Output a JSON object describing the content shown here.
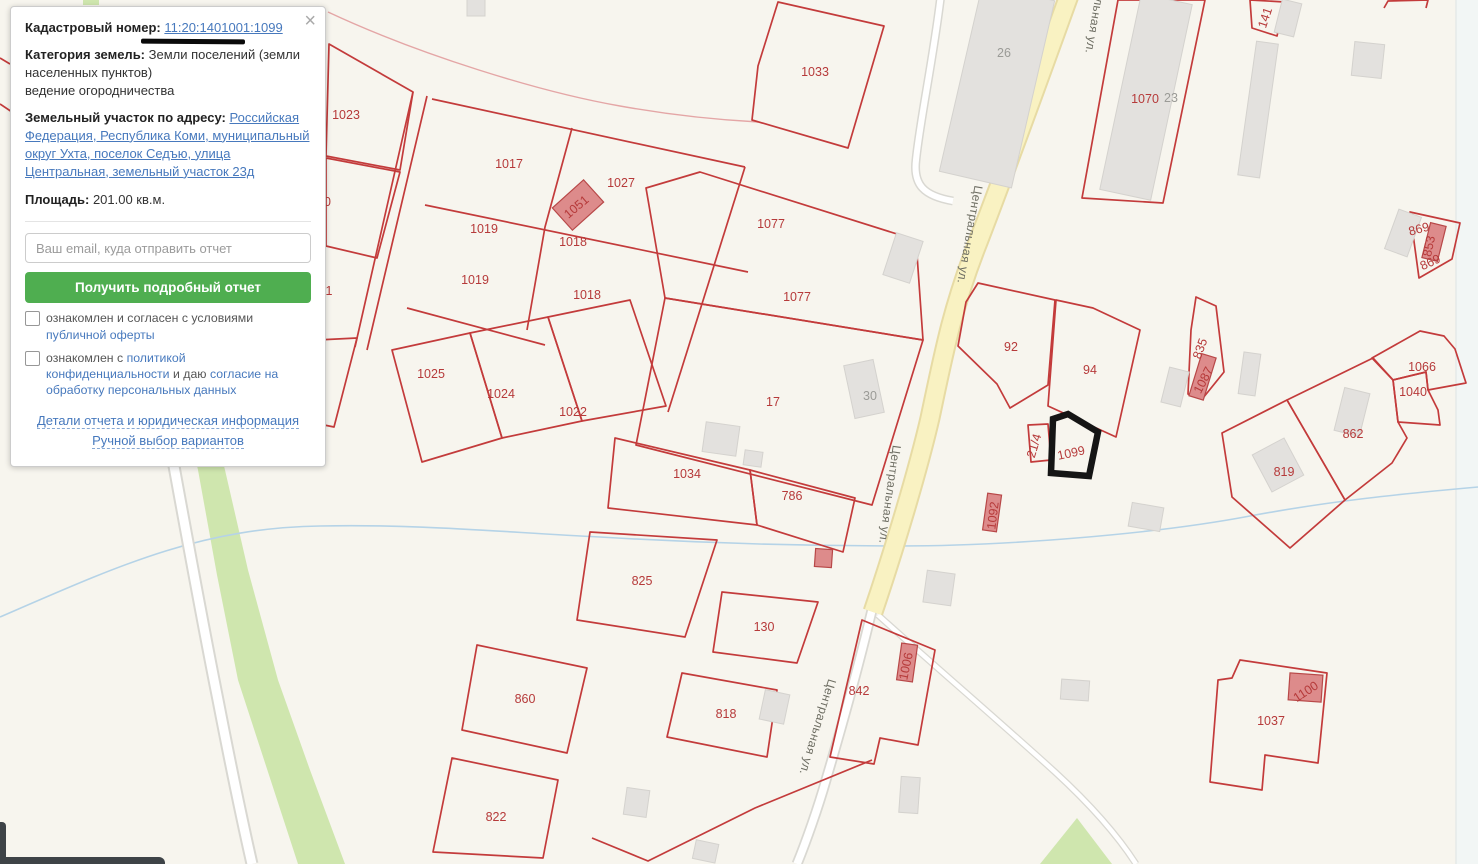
{
  "colors": {
    "background": "#f7f5ee",
    "parcel": "#c33b3b",
    "label_red": "#b63a3a",
    "label_grey": "#9b9b97",
    "street_text": "#6d6d62",
    "road_yellow": "#f9f2c2",
    "road_yellow_edge": "#e7dba4",
    "creek": "#b5d3e7",
    "vegetation": "#cfe6ae",
    "building_grey": "#e3e1de",
    "building_red": "#dd8b8b",
    "building_red_edge": "#b84848",
    "highlight": "#151515",
    "link_blue": "#4779bd",
    "button_green": "#4fae50"
  },
  "panel": {
    "close_icon": "×",
    "cadastral_label": "Кадастровый номер:",
    "cadastral_number": "11:20:1401001:1099",
    "category_label": "Категория земель:",
    "category_value": "Земли поселений (земли населенных пунктов)",
    "category_extra": "ведение огородничества",
    "address_label": "Земельный участок по адресу:",
    "address_link": "Российская Федерация, Республика Коми, муниципальный округ Ухта, поселок Седъю, улица Центральная, земельный участок 23д",
    "area_label": "Площадь:",
    "area_value": "201.00 кв.м.",
    "email_placeholder": "Ваш email, куда отправить отчет",
    "submit_button": "Получить подробный отчет",
    "checkbox1_text": "ознакомлен и согласен с условиями",
    "checkbox1_link": "публичной оферты",
    "checkbox2_text": "ознакомлен с",
    "checkbox2_link": "политикой конфиденциальности",
    "checkbox2_text2": "и даю",
    "checkbox2_link2": "согласие на обработку персональных данных",
    "details_link": "Детали отчета и юридическая информация",
    "manual_link": "Ручной выбор вариантов"
  },
  "map": {
    "highlighted_parcel": "1099",
    "street_name": "Центральная ул.",
    "labels": [
      [
        "1033",
        815,
        76,
        0,
        "p"
      ],
      [
        "1023",
        346,
        119,
        0,
        "p"
      ],
      [
        "1017",
        509,
        168,
        0,
        "p"
      ],
      [
        "1027",
        621,
        187,
        0,
        "p"
      ],
      [
        "1020",
        317,
        206,
        0,
        "p"
      ],
      [
        "1019",
        484,
        233,
        0,
        "p"
      ],
      [
        "1018",
        573,
        246,
        0,
        "p"
      ],
      [
        "1019",
        475,
        284,
        0,
        "p"
      ],
      [
        "1018",
        587,
        299,
        0,
        "p"
      ],
      [
        "1",
        329,
        295,
        0,
        "p"
      ],
      [
        "1026",
        312,
        376,
        0,
        "p"
      ],
      [
        "1025",
        431,
        378,
        0,
        "p"
      ],
      [
        "1024",
        501,
        398,
        0,
        "p"
      ],
      [
        "1022",
        573,
        416,
        0,
        "p"
      ],
      [
        "1034",
        687,
        478,
        0,
        "p"
      ],
      [
        "786",
        792,
        500,
        0,
        "p"
      ],
      [
        "17",
        773,
        406,
        0,
        "p"
      ],
      [
        "1077",
        771,
        228,
        0,
        "p"
      ],
      [
        "1077",
        797,
        301,
        0,
        "p"
      ],
      [
        "92",
        1011,
        351,
        0,
        "p"
      ],
      [
        "94",
        1090,
        374,
        0,
        "p"
      ],
      [
        "21/4",
        1038,
        447,
        -73,
        "p"
      ],
      [
        "1099",
        1072,
        457,
        -12,
        "p"
      ],
      [
        "835",
        1204,
        350,
        -70,
        "p"
      ],
      [
        "1087",
        1207,
        382,
        -63,
        "p"
      ],
      [
        "869",
        1420,
        233,
        -15,
        "p"
      ],
      [
        "853",
        1433,
        247,
        -78,
        "p"
      ],
      [
        "869",
        1432,
        266,
        -25,
        "p"
      ],
      [
        "1066",
        1422,
        371,
        0,
        "p"
      ],
      [
        "1040",
        1413,
        396,
        0,
        "p"
      ],
      [
        "862",
        1353,
        438,
        0,
        "p"
      ],
      [
        "819",
        1284,
        476,
        0,
        "p"
      ],
      [
        "1070",
        1145,
        103,
        0,
        "p"
      ],
      [
        "141",
        1269,
        19,
        -72,
        "p"
      ],
      [
        "1092",
        997,
        516,
        -83,
        "p"
      ],
      [
        "825",
        642,
        585,
        0,
        "p"
      ],
      [
        "130",
        764,
        631,
        0,
        "p"
      ],
      [
        "860",
        525,
        703,
        0,
        "p"
      ],
      [
        "818",
        726,
        718,
        0,
        "p"
      ],
      [
        "842",
        859,
        695,
        0,
        "p"
      ],
      [
        "1006",
        910,
        667,
        -78,
        "p"
      ],
      [
        "822",
        496,
        821,
        0,
        "p"
      ],
      [
        "1037",
        1271,
        725,
        0,
        "p"
      ],
      [
        "1100",
        1308,
        695,
        -33,
        "p"
      ],
      [
        "1051",
        579,
        210,
        -40,
        "p"
      ],
      [
        "26",
        1004,
        57,
        0,
        "g"
      ],
      [
        "23",
        1171,
        102,
        0,
        "g"
      ],
      [
        "30",
        870,
        400,
        0,
        "g"
      ],
      [
        "Центральная ул.",
        1094,
        4,
        100,
        "s"
      ],
      [
        "Центральная ул.",
        966,
        234,
        100,
        "s"
      ],
      [
        "Центральная ул.",
        886,
        494,
        98,
        "s"
      ],
      [
        "Центральная ул.",
        814,
        726,
        107,
        "s"
      ]
    ]
  }
}
